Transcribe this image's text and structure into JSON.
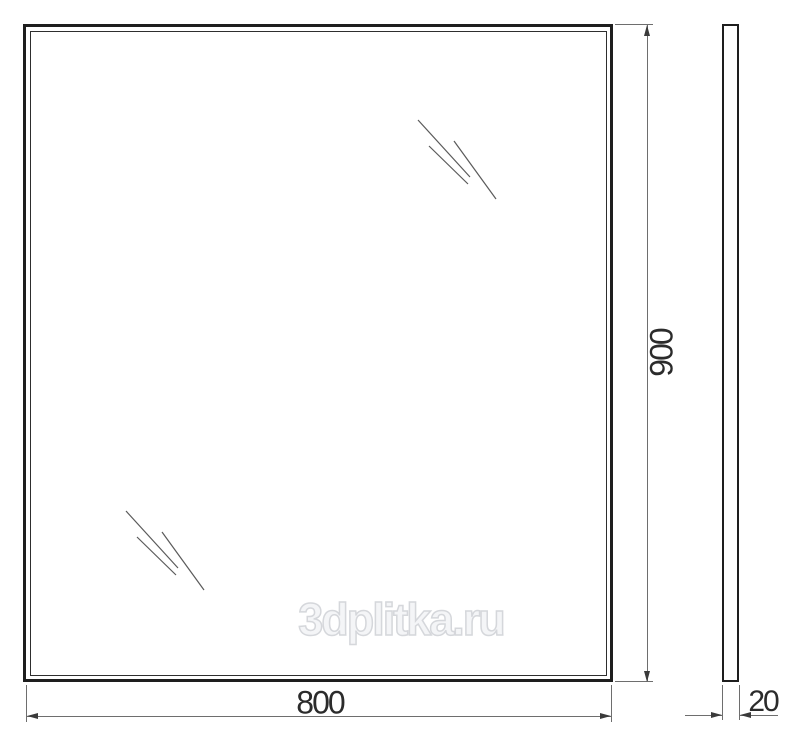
{
  "drawing": {
    "type": "mirror-technical-drawing",
    "front_view": {
      "width_label": "800",
      "height_label": "900"
    },
    "side_view": {
      "thickness_label": "20"
    },
    "watermark_text": "3dplitka.ru",
    "colors": {
      "outline": "#1e1e1e",
      "dimension_line": "#6e6e6e",
      "arrowhead": "#3a3a3a",
      "dimension_text": "#2b2b2b",
      "watermark_outline": "#d5d7db",
      "background": "#ffffff"
    }
  }
}
